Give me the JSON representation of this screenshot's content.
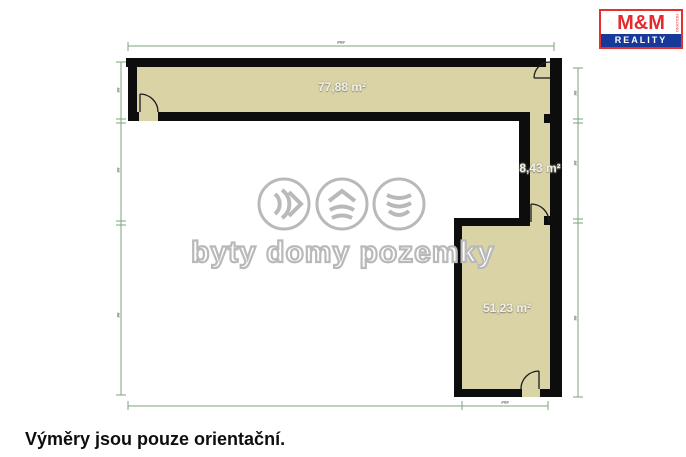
{
  "logo": {
    "brand": "M&M",
    "sub": "REALITY",
    "holding": "HOLDING"
  },
  "watermark": {
    "slogan": "byty domy pozemky"
  },
  "floorplan": {
    "rooms": [
      {
        "id": "top-room",
        "area": "77,88 m²"
      },
      {
        "id": "corridor",
        "area": "8,43 m²"
      },
      {
        "id": "bottom-right-room",
        "area": "51,23 m²"
      }
    ],
    "dimension_labels": {
      "top": "###",
      "bottom_right": "###",
      "left_upper": "##",
      "left_middle": "##",
      "left_lower": "##",
      "right_upper": "##",
      "right_middle": "##",
      "right_lower": "##"
    },
    "colors": {
      "wall": "#0d0d0d",
      "room_fill": "#d9d3a6",
      "dimension_line": "#79a579",
      "watermark_gray": "#b9b9b9",
      "logo_red": "#e42a2e",
      "logo_blue": "#16399a"
    }
  },
  "page": {
    "caption": "Výměry jsou pouze orientační."
  }
}
